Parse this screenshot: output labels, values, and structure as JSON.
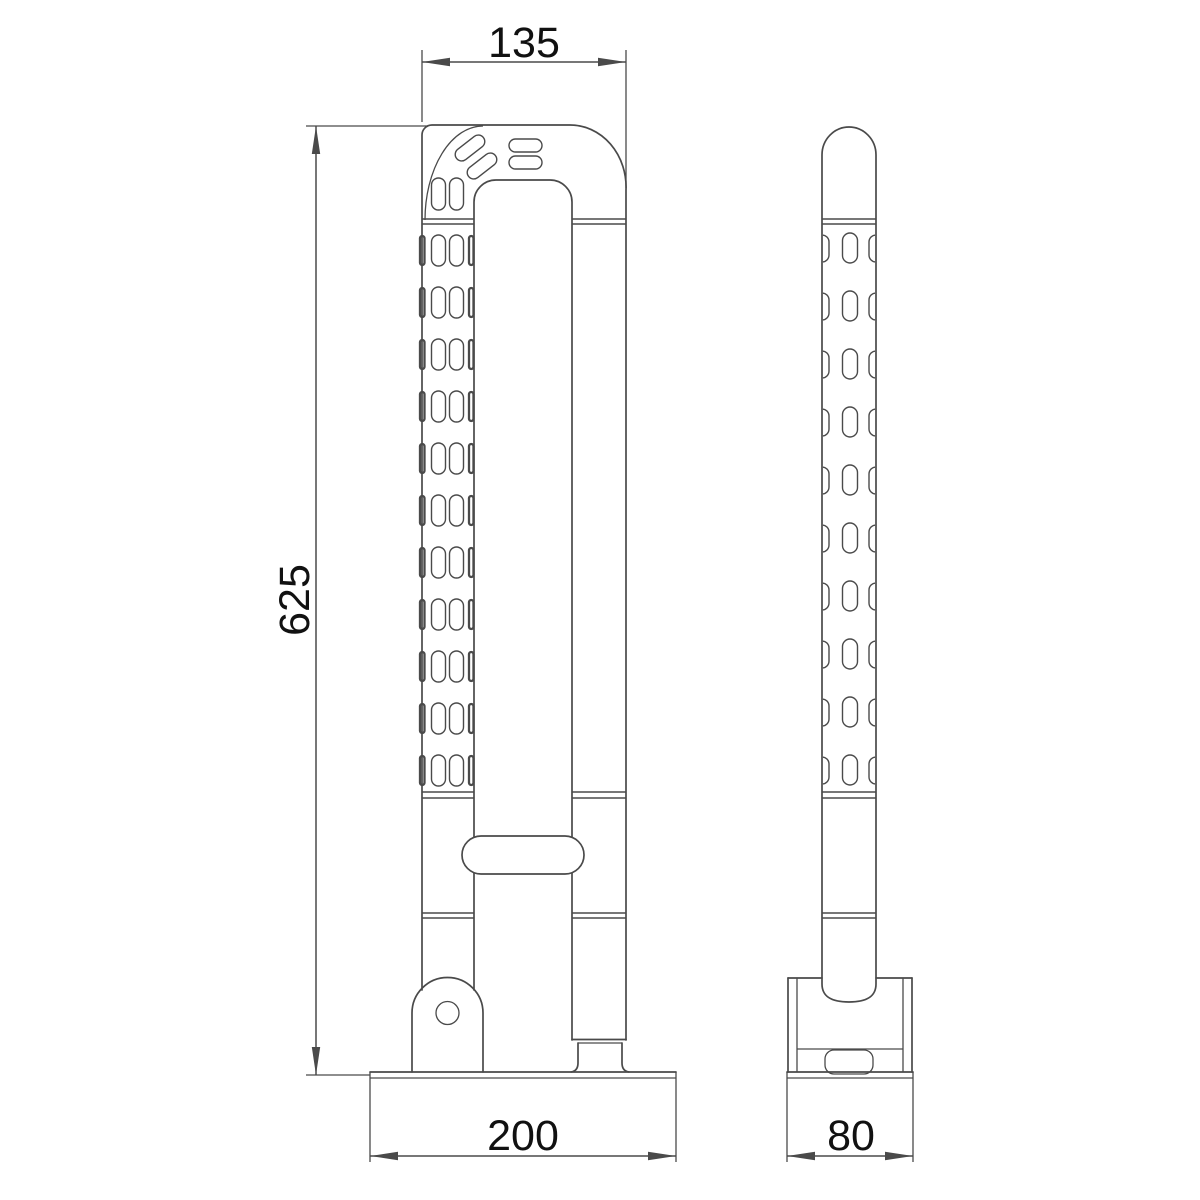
{
  "drawing": {
    "type": "technical-dimension-drawing",
    "views": {
      "front": {
        "dimensions": {
          "top_width": "135",
          "overall_height": "625",
          "base_length": "200"
        }
      },
      "side": {
        "dimensions": {
          "base_depth": "80"
        }
      }
    }
  },
  "style": {
    "background": "#ffffff",
    "line_color": "#4a4a4a",
    "text_color": "#111111"
  }
}
